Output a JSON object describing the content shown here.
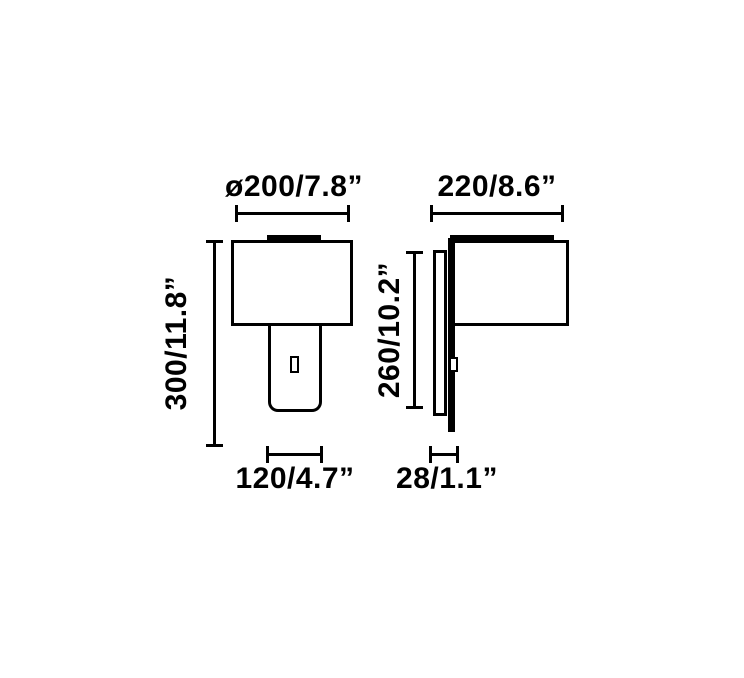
{
  "diagram": {
    "colors": {
      "line": "#000000",
      "background": "#ffffff"
    },
    "front_view": {
      "shade_diameter_label": "ø200/7.8”",
      "overall_height_label": "300/11.8”",
      "body_width_label": "120/4.7”"
    },
    "side_view": {
      "overall_depth_label": "220/8.6”",
      "back_height_label": "260/10.2”",
      "wall_bracket_depth_label": "28/1.1”"
    }
  }
}
